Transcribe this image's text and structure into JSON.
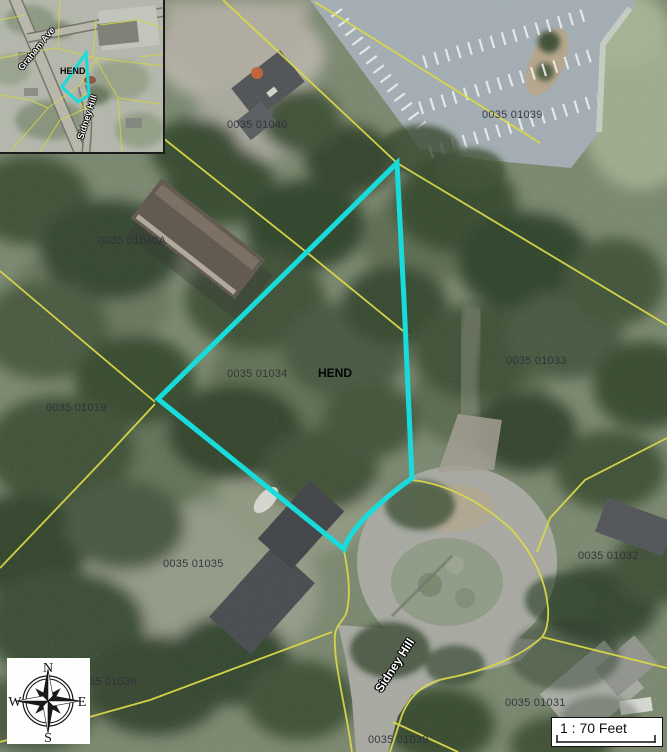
{
  "map": {
    "area_label": "HEND",
    "street_label": "Sidney Hill",
    "parcel_labels": [
      {
        "text": "0035 01040",
        "x": 227,
        "y": 119
      },
      {
        "text": "0035 01039",
        "x": 482,
        "y": 109
      },
      {
        "text": "0035 01040A",
        "x": 98,
        "y": 235
      },
      {
        "text": "0035 01034",
        "x": 227,
        "y": 368
      },
      {
        "text": "0035 01019",
        "x": 46,
        "y": 402
      },
      {
        "text": "0035 01033",
        "x": 506,
        "y": 355
      },
      {
        "text": "0035 01035",
        "x": 163,
        "y": 558
      },
      {
        "text": "0035 01032",
        "x": 578,
        "y": 550
      },
      {
        "text": "0035 01036",
        "x": 76,
        "y": 676
      },
      {
        "text": "0035 01031",
        "x": 505,
        "y": 697
      },
      {
        "text": "0035 01039",
        "x": 368,
        "y": 734
      }
    ],
    "colors": {
      "highlight": "#18dcdc",
      "parcel_line": "#d9d948",
      "label_text": "#30303a"
    }
  },
  "inset": {
    "street1": "Graham Ave",
    "street2": "Sidney Hill",
    "area_label": "HEND"
  },
  "compass": {
    "north": "N",
    "east": "E",
    "south": "S",
    "west": "W"
  },
  "scale": {
    "text": "1 : 70 Feet"
  }
}
